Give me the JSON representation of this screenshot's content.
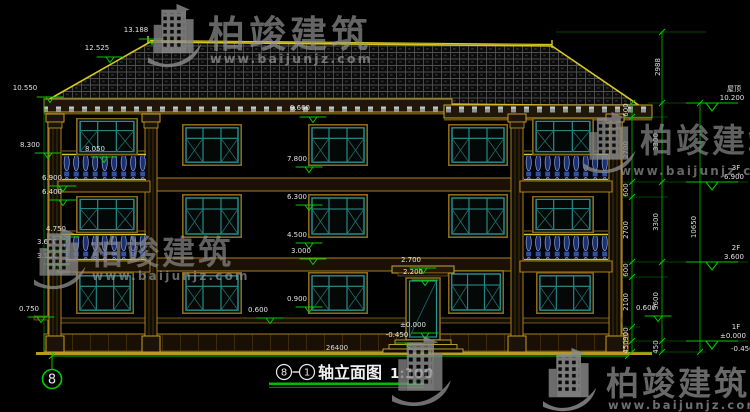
{
  "watermark": {
    "brand": "柏竣建筑",
    "url": "www.baijunjz.com"
  },
  "title": {
    "axis_from": "8",
    "axis_to": "1",
    "name": "轴立面图",
    "scale": "1:100"
  },
  "grid_bubble": "8",
  "ground_dim": "26400",
  "elevations": {
    "ridge": "13.188",
    "hip": "12.525",
    "eave_left": "10.550",
    "eave_mid": "9.660",
    "l_830": "8.300",
    "l_805": "8.050",
    "l_690": "6.900",
    "l_640": "6.400",
    "l_475": "4.750",
    "l_360": "3.600",
    "l_310": "3.100",
    "l_075": "0.750",
    "m_780": "7.800",
    "m_630": "6.300",
    "m_450": "4.500",
    "m_300": "3.000",
    "m_090": "0.900",
    "m_060": "0.600",
    "d_270": "2.700",
    "d_220": "2.200",
    "d_000": "±0.000",
    "d_neg": "-0.450"
  },
  "floor_markers": {
    "roof_label": "屋顶",
    "roof_val": "10.200",
    "f3_label": "3F",
    "f3_val": "6.900",
    "f2_label": "2F",
    "f2_val": "3.600",
    "f1_label": "1F",
    "f1_val": "±0.000",
    "below_val": "-0.450"
  },
  "dims_right": {
    "top": "2988",
    "colA": [
      "600",
      "2700",
      "600",
      "2700",
      "600",
      "2100",
      "900",
      "450"
    ],
    "colB": [
      "3300",
      "3300",
      "3600",
      "450"
    ],
    "colC": "10650"
  },
  "colors": {
    "accent_green": "#00cc00",
    "line_yellow": "#d8c820",
    "window_teal": "#2a9494",
    "baluster_navy": "#24408c",
    "frame_brown": "#8a6a1a"
  }
}
